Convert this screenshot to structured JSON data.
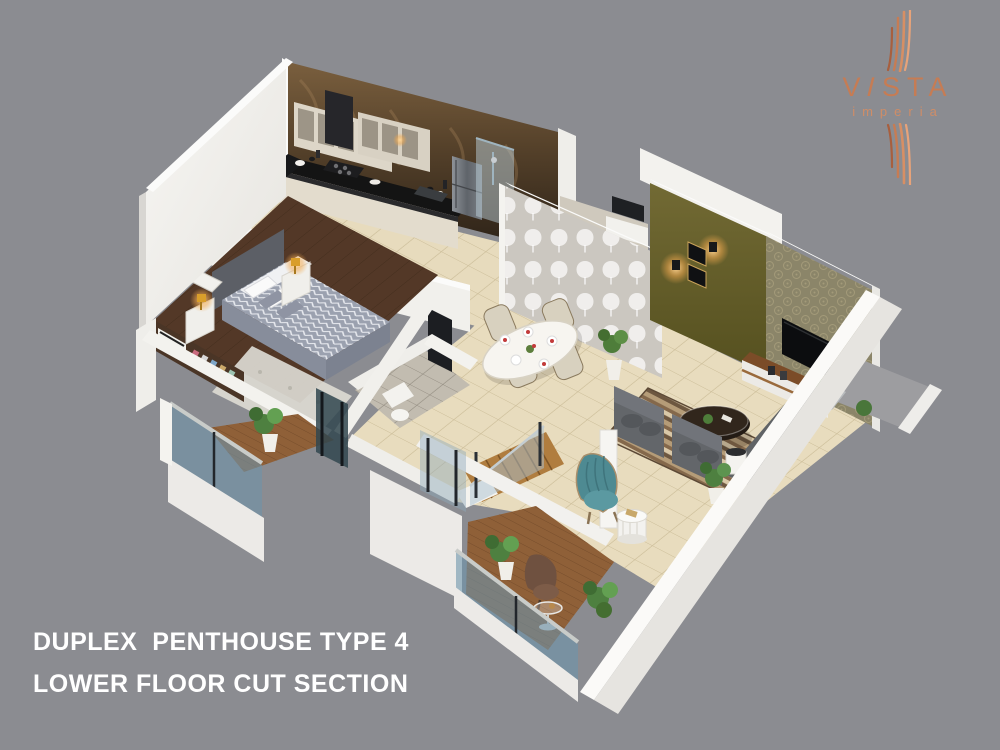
{
  "branding": {
    "brand": "VISTA",
    "brand_display": {
      "l1": "V",
      "l2": "I",
      "l3": "S",
      "l4": "T",
      "l5": "A"
    },
    "sub_brand": "imperia"
  },
  "caption": {
    "line1": "DUPLEX  PENTHOUSE TYPE 4",
    "line2": "LOWER FLOOR CUT SECTION"
  },
  "palette": {
    "background": "#8b8c91",
    "caption_text": "#ffffff",
    "logo_copper": "#c67c54",
    "logo_copper_light": "#e8a379",
    "wall_white": "#f2f1ed",
    "wall_shadow": "#d9d7d2",
    "floor_marble": "#e7dbbd",
    "floor_wood": "#5a3e2a",
    "kitchen_marble_wall": "#4a3a26",
    "accent_olive": "#6a6330",
    "wallpaper_gray": "#cbc7c0",
    "wallpaper_damask": "#8b8569",
    "sofa_gray": "#63666a",
    "chair_teal": "#4e8a92",
    "glass_blue": "#7f9fb4",
    "deck_wood": "#8f6038",
    "lamp_glow": "#f2b95e"
  }
}
